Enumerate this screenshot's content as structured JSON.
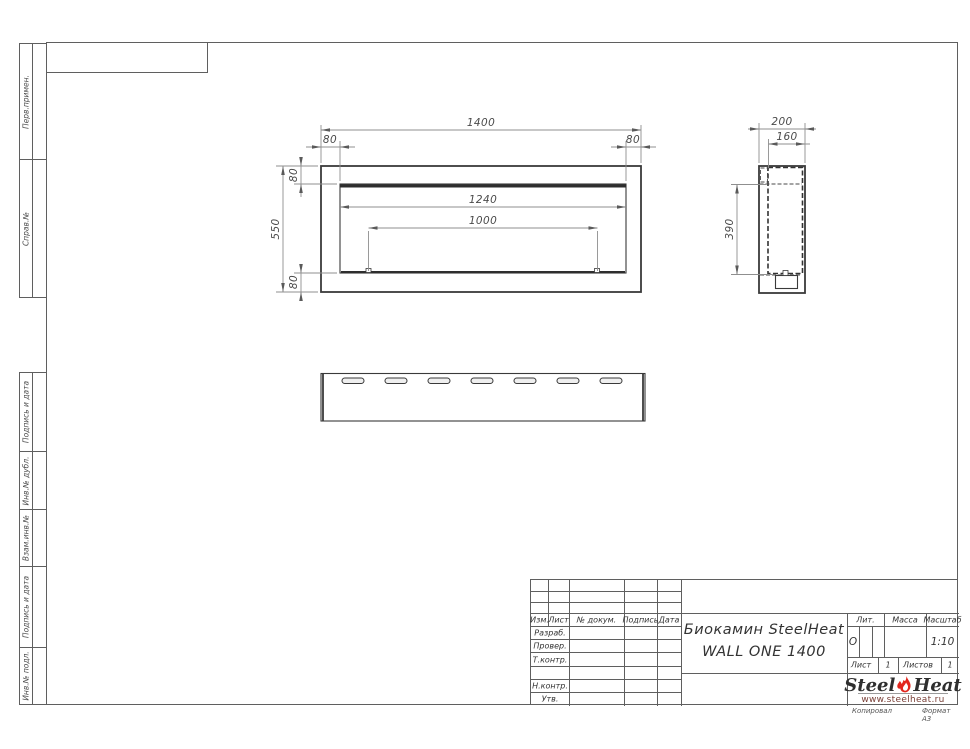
{
  "side_column": {
    "upper_cells": [
      "Перв.примен.",
      "Справ.№"
    ],
    "lower_cells": [
      "Подпись и дата",
      "Инв.№ дубл.",
      "Взам.инв.№",
      "Подпись и дата",
      "Инв.№ подл."
    ]
  },
  "drawing": {
    "front": {
      "total_width": "1400",
      "inset_left": "80",
      "inset_right": "80",
      "inset_top": "80",
      "inset_bottom": "80",
      "height": "550",
      "opening_width": "1240",
      "burner_width": "1000"
    },
    "side": {
      "depth": "200",
      "inner_depth": "160",
      "inner_height": "390"
    }
  },
  "title_block": {
    "revision_header": {
      "izm": "Изм.",
      "sheet": "Лист",
      "doc": "№ докум.",
      "sign": "Подпись",
      "date": "Дата"
    },
    "signature_rows": [
      "Разраб.",
      "Провер.",
      "Т.контр.",
      "",
      "Н.контр.",
      "Утв."
    ],
    "product_name_line1": "Биокамин SteelHeat",
    "product_name_line2": "WALL ONE 1400",
    "lit": {
      "label": "Лит.",
      "value": "О"
    },
    "mass": {
      "label": "Масса",
      "value": ""
    },
    "scale": {
      "label": "Масштаб",
      "value": "1:10"
    },
    "sheet": {
      "label": "Лист",
      "value": "1"
    },
    "sheets": {
      "label": "Листов",
      "value": "1"
    },
    "logo": {
      "brand_part1": "Steel",
      "brand_part2": "Heat",
      "website": "www.steelheat.ru"
    },
    "footer": {
      "copy": "Копировал",
      "format": "Формат А3"
    }
  },
  "colors": {
    "flame_red": "#e2261d",
    "line_dark": "#3a3a3a",
    "line_thin": "#8f8f8f"
  }
}
